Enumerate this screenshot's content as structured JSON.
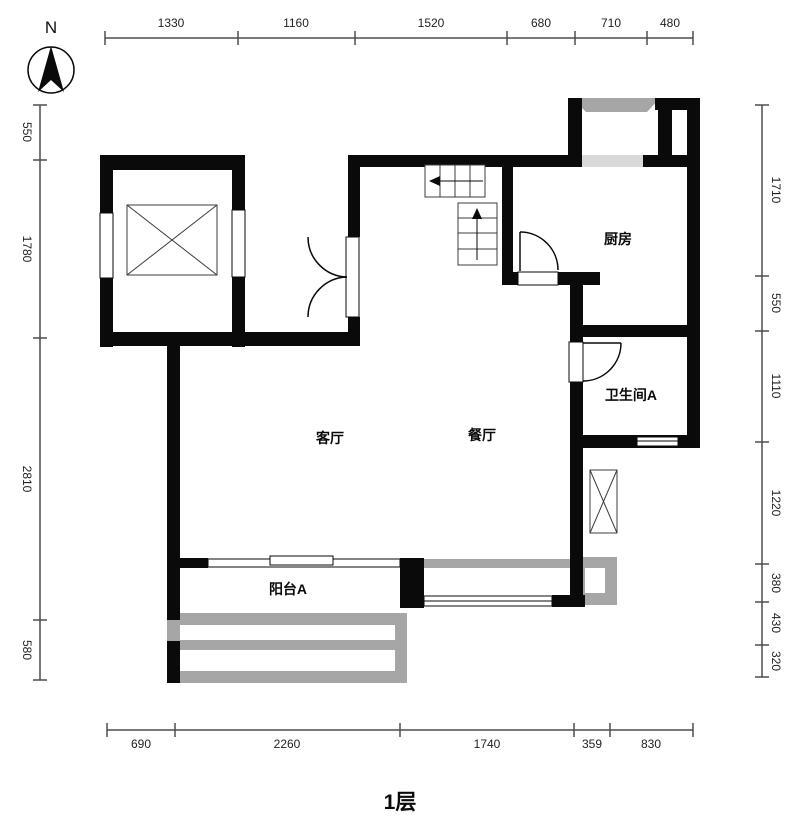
{
  "title": "1层",
  "compass": {
    "north_label": "N"
  },
  "rooms": {
    "kitchen": "厨房",
    "bathroom_a": "卫生间A",
    "living": "客厅",
    "dining": "餐厅",
    "balcony_a": "阳台A"
  },
  "dims": {
    "top": [
      "1330",
      "1160",
      "1520",
      "680",
      "710",
      "480"
    ],
    "bottom": [
      "690",
      "2260",
      "1740",
      "359",
      "830"
    ],
    "left": [
      "550",
      "1780",
      "2810",
      "580"
    ],
    "right": [
      "1710",
      "550",
      "1110",
      "1220",
      "380",
      "430",
      "320"
    ]
  },
  "colors": {
    "wall": "#0a0a0a",
    "railing_gray": "#a6a6a6",
    "window_gray": "#d9d9d9",
    "dim_line": "#4d4d4d"
  }
}
